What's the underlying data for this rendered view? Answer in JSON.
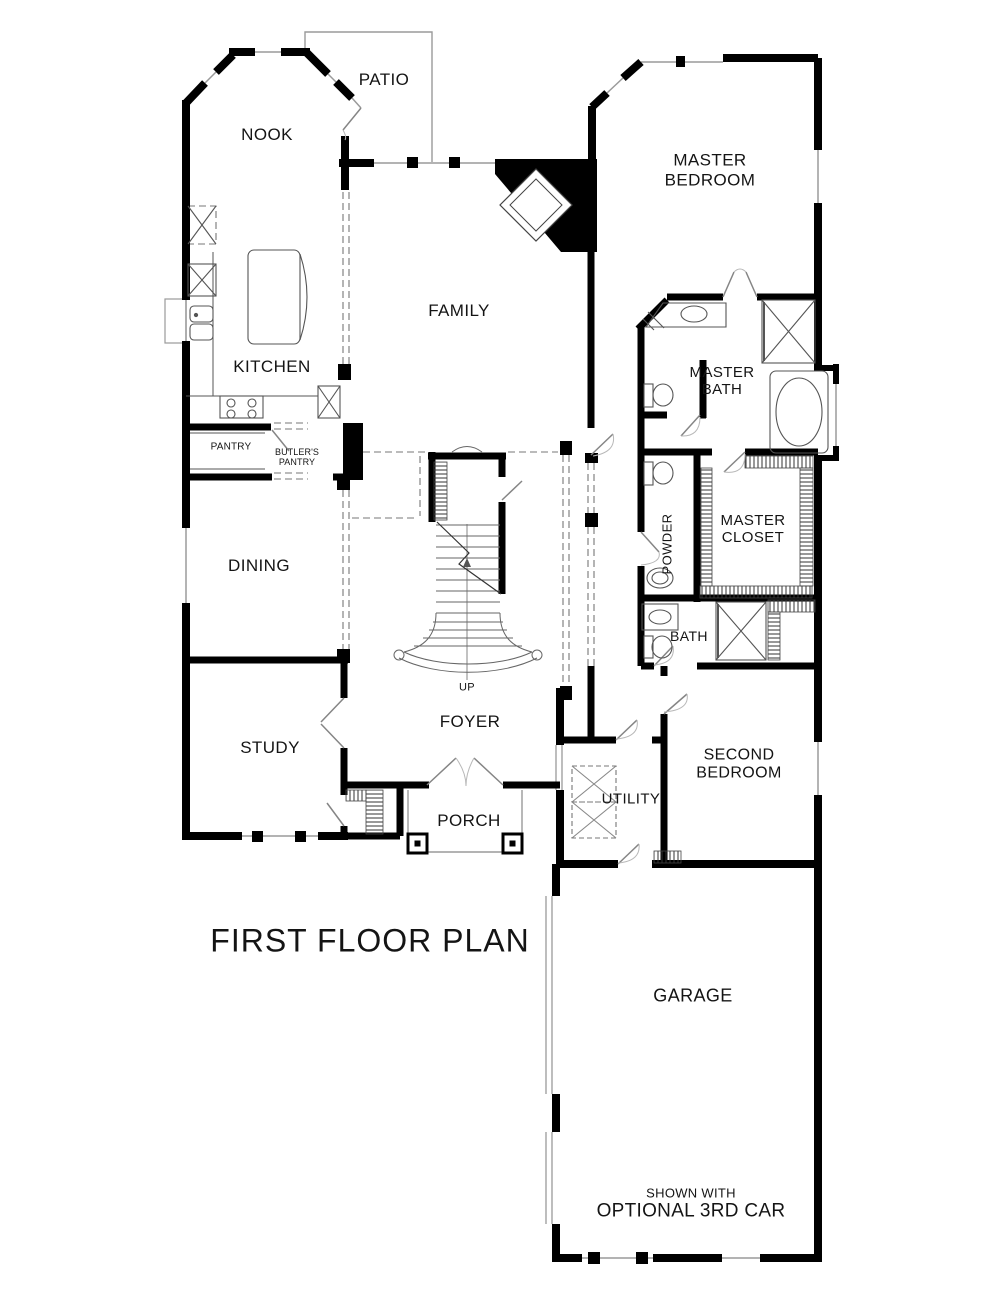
{
  "title": "FIRST FLOOR PLAN",
  "rooms": {
    "patio": "PATIO",
    "nook": "NOOK",
    "master_bedroom": "MASTER\nBEDROOM",
    "family": "FAMILY",
    "kitchen": "KITCHEN",
    "master_bath": "MASTER\nBATH",
    "pantry": "PANTRY",
    "butlers_pantry": "BUTLER'S\nPANTRY",
    "master_closet": "MASTER\nCLOSET",
    "dining": "DINING",
    "powder": "POWDER",
    "bath": "BATH",
    "study": "STUDY",
    "foyer": "FOYER",
    "second_bedroom": "SECOND\nBEDROOM",
    "utility": "UTILITY",
    "porch": "PORCH",
    "garage": "GARAGE",
    "up": "UP"
  },
  "garage_note": {
    "line1": "SHOWN WITH",
    "line2": "OPTIONAL 3RD CAR"
  },
  "colors": {
    "wall": "#000000",
    "thin_line": "#9a9a9a",
    "dashed_line": "#777777",
    "background": "#ffffff"
  }
}
